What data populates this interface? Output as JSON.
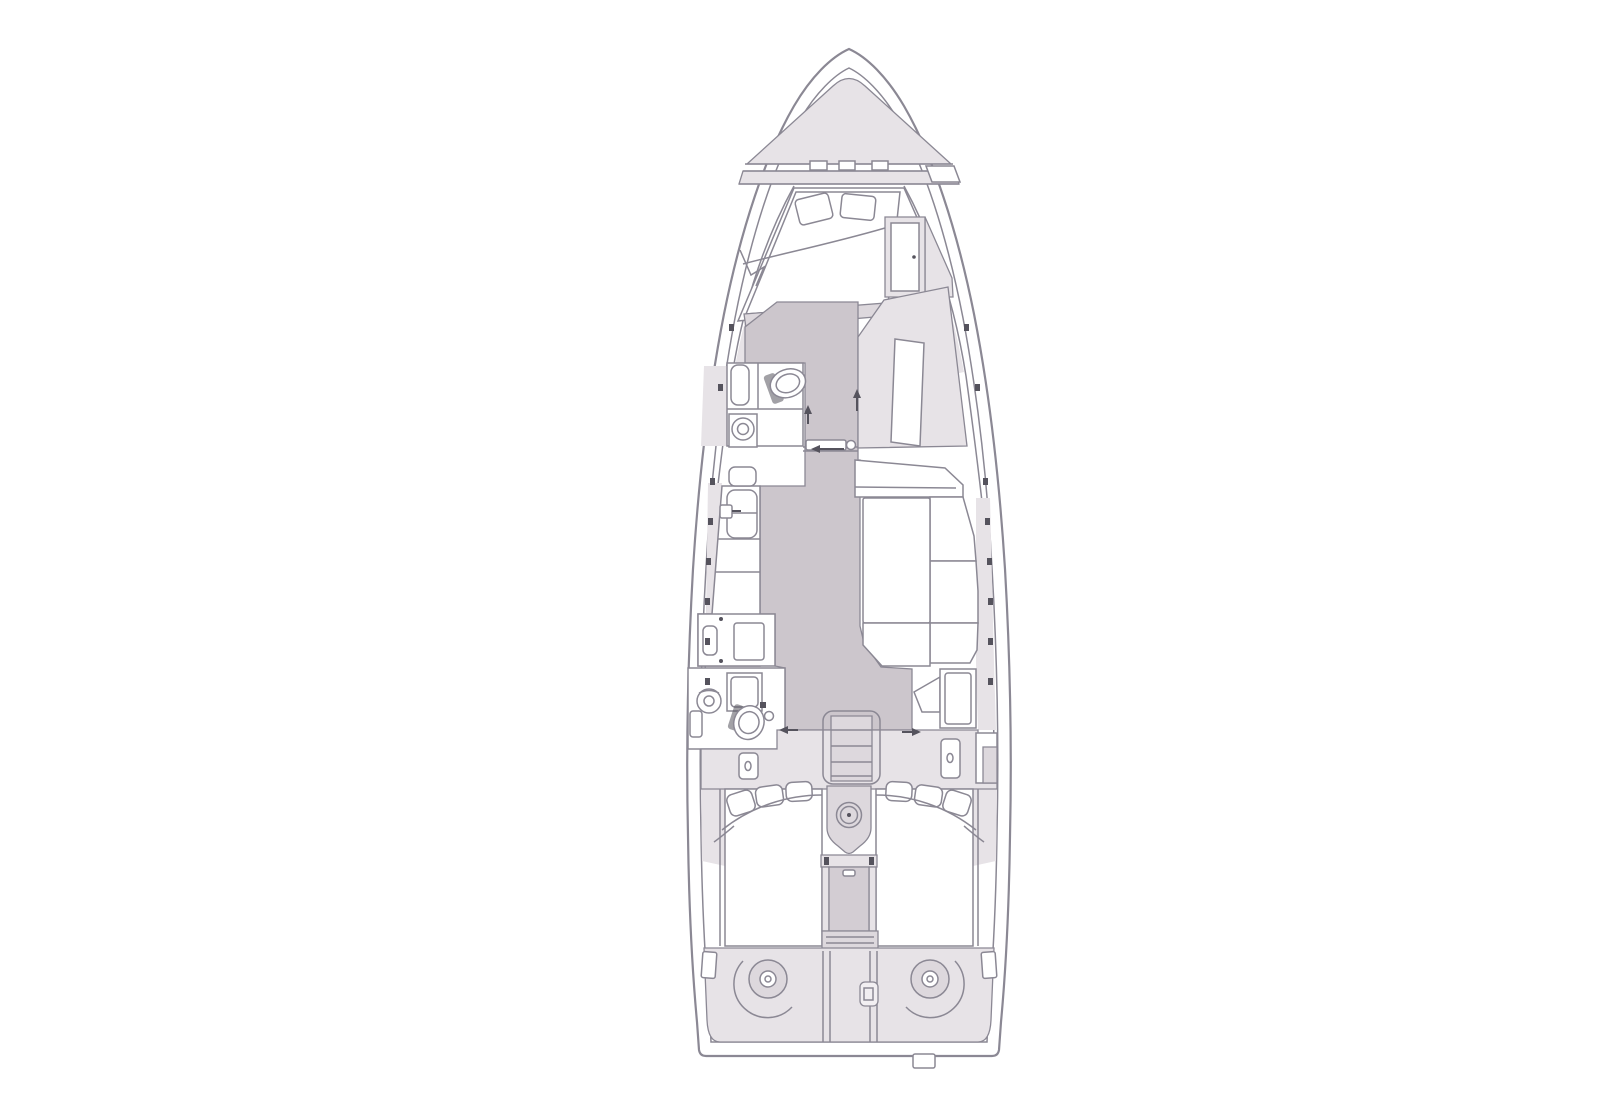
{
  "document": {
    "title": "Sailboat interior layout plan, top view, bow up",
    "type": "boat-floor-plan",
    "visible_text": ""
  },
  "colors": {
    "background": "#ffffff",
    "line": "#8b8894",
    "dark": "#55535d",
    "shade": "#e7e3e7",
    "shade2": "#ddd8dd",
    "floor": "#ccc6cc",
    "stairs": "#c9c3c9",
    "walk": "#d3cdd3",
    "white": "#ffffff"
  },
  "vessel": {
    "orientation": "bow-up",
    "centerline_x": 809,
    "bow_tip_y": 33,
    "stern_y": 1040,
    "max_beam": {
      "left_x": 646,
      "right_x": 972
    }
  },
  "areas": [
    {
      "id": "foredeck",
      "label": "Foredeck with anchor windlass band and deck hatches"
    },
    {
      "id": "forward-cabin",
      "label": "Forward V-berth cabin with double bed, two pillows and wardrobe"
    },
    {
      "id": "forward-head",
      "label": "Forward head with toilet, round sink and shower"
    },
    {
      "id": "starboard-unit",
      "label": "Starboard wardrobe unit with slanted door"
    },
    {
      "id": "galley",
      "label": "Port galley with twin sinks, counters and stove-oven"
    },
    {
      "id": "salon-dinette",
      "label": "Starboard salon dinette with table and settee"
    },
    {
      "id": "aft-head",
      "label": "Aft head with shower, round sink and toilet"
    },
    {
      "id": "chart-corner",
      "label": "Aft starboard seat and cabinet"
    },
    {
      "id": "companionway",
      "label": "Companionway stairs"
    },
    {
      "id": "cockpit",
      "label": "Cockpit with lockers, seat cushions and steering pedestal with wheel"
    },
    {
      "id": "aft-cabin-port",
      "label": "Port aft cabin berth with pillows"
    },
    {
      "id": "aft-cabin-starboard",
      "label": "Starboard aft cabin berth with pillows"
    },
    {
      "id": "transom",
      "label": "Transom deck with two winches, center gate and stern fitting"
    }
  ],
  "fixtures": [
    "anchor-windlass",
    "deck-hatch",
    "double-berth",
    "pillow",
    "wardrobe",
    "toilet",
    "round-sink",
    "shower-pan",
    "twin-sink",
    "faucet",
    "stove-oven",
    "dinette-table",
    "settee",
    "door-leaf",
    "door-pivot",
    "direction-arrow",
    "cockpit-locker",
    "companionway-stairs",
    "steering-wheel",
    "pedestal",
    "aft-berth",
    "winch",
    "transom-gate",
    "stern-fitting",
    "stanchion-tick"
  ]
}
